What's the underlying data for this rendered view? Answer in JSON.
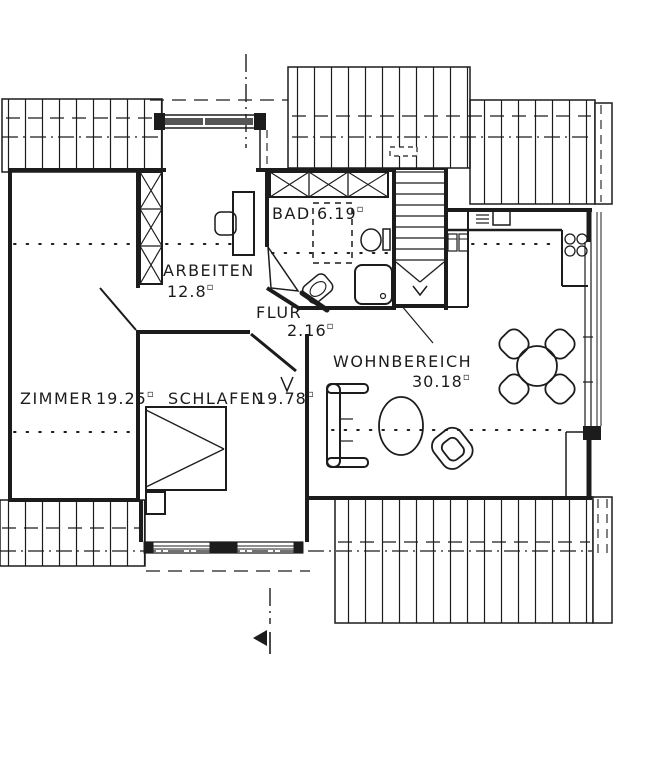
{
  "plan": {
    "drawing_type": "attic floor plan",
    "unit": "▫",
    "colors": {
      "ink": "#1c1c1c",
      "paper": "#ffffff"
    },
    "rooms": [
      {
        "id": "zimmer",
        "name": "ZIMMER",
        "area": "19.25"
      },
      {
        "id": "schlafen",
        "name": "SCHLAFEN",
        "area": "19.78"
      },
      {
        "id": "arbeiten",
        "name": "ARBEITEN",
        "area": "12.8"
      },
      {
        "id": "bad",
        "name": "BAD",
        "area": "6.19"
      },
      {
        "id": "flur",
        "name": "FLUR",
        "area": "2.16"
      },
      {
        "id": "wohnbereich",
        "name": "WOHNBEREICH",
        "area": "30.18"
      }
    ]
  }
}
